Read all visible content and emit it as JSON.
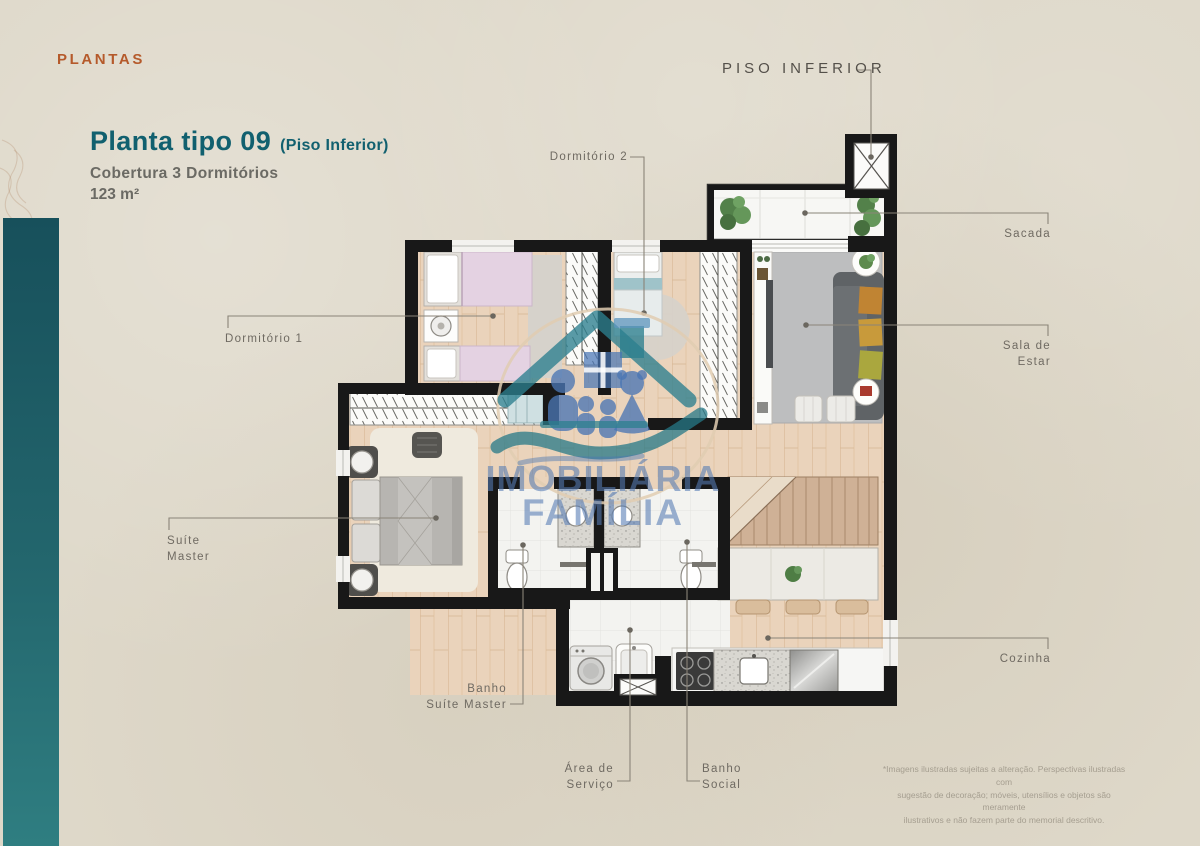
{
  "page": {
    "eyebrow": "PLANTAS",
    "title": "Planta tipo 09",
    "title_note": "(Piso Inferior)",
    "subtitle": "Cobertura 3 Dormitórios",
    "area": "123 m²",
    "floor_label": "PISO INFERIOR"
  },
  "floorplan": {
    "labels": {
      "dormitorio_1": "Dormitório 1",
      "dormitorio_2": "Dormitório 2",
      "sacada": "Sacada",
      "sala_de_estar": [
        "Sala de",
        "Estar"
      ],
      "suite_master": [
        "Suíte",
        "Master"
      ],
      "banho_suite_master": [
        "Banho",
        "Suíte Master"
      ],
      "area_de_servico": [
        "Área de",
        "Serviço"
      ],
      "banho_social": [
        "Banho",
        "Social"
      ],
      "cozinha": "Cozinha"
    }
  },
  "watermark": {
    "line1": "IMOBILIÁRIA",
    "line2": "FAMÍLIA"
  },
  "disclaimer": {
    "lines": [
      "*Imagens ilustradas sujeitas a alteração. Perspectivas ilustradas com",
      "sugestão de decoração; móveis, utensílios e objetos são meramente",
      "ilustrativos e não fazem parte do memorial descritivo."
    ]
  },
  "colors": {
    "paper": "#ded8c9",
    "accent_orange": "#b55a2b",
    "accent_teal": "#11606f",
    "bar_teal_top": "#17505b",
    "bar_teal_bottom": "#2f7e81",
    "wall": "#181818",
    "wood_floor": "#ead3bb",
    "rug_gray": "#bdbebf",
    "label_gray": "#6f6a62",
    "watermark_blue": "#4a76b4",
    "watermark_teal": "#2b7f8e"
  }
}
